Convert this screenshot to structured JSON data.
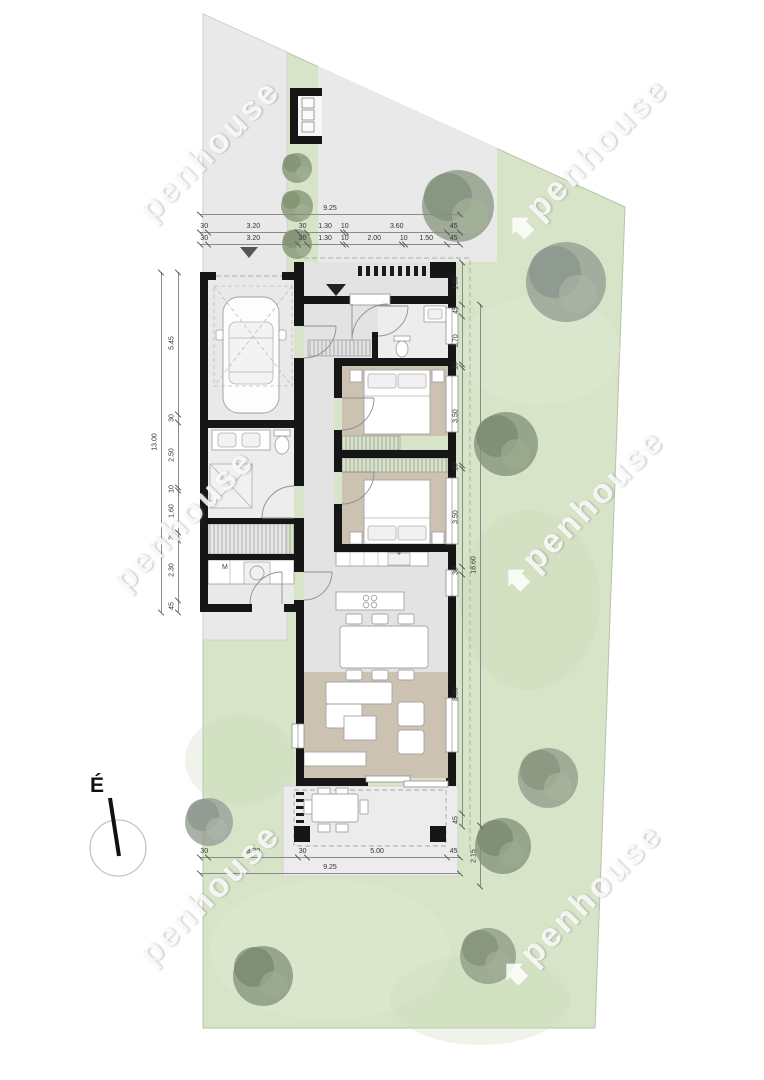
{
  "title": "Site and floor plan",
  "watermark": {
    "brand": "Openhouse",
    "text": "penhouse"
  },
  "north": {
    "label": "É"
  },
  "labels": {
    "washing_machine": "M"
  },
  "dimensions": {
    "top_total": [
      "9.25"
    ],
    "top_row1": [
      "30",
      "3.20",
      "30",
      "1.30",
      "10",
      "3.60",
      "45"
    ],
    "top_row2": [
      "30",
      "3.20",
      "30",
      "1.30",
      "10",
      "2.00",
      "10",
      "1.50",
      "45"
    ],
    "left_total": [
      "13.00"
    ],
    "left_inner": [
      "5.45",
      "30",
      "2.50",
      "10",
      "1.60",
      "30",
      "2.30",
      "45"
    ],
    "right_inner": [
      "1.50",
      "45",
      "1.70",
      "10",
      "3.50",
      "10",
      "3.50",
      "30",
      "8.50",
      "45"
    ],
    "right_outer": [
      "18.60",
      "2.15"
    ],
    "bottom_row": [
      "30",
      "3.20",
      "30",
      "5.00",
      "45"
    ],
    "bottom_total": [
      "9.25"
    ]
  },
  "colors": {
    "grass": "#d7e4c8",
    "paving": "#e9e9e9",
    "wall": "#161616",
    "warm_floor": "#ccc2b1",
    "cool_floor": "#e3e3e3",
    "tree_grey": "#99a396",
    "tree_green": "#8a9a80"
  }
}
